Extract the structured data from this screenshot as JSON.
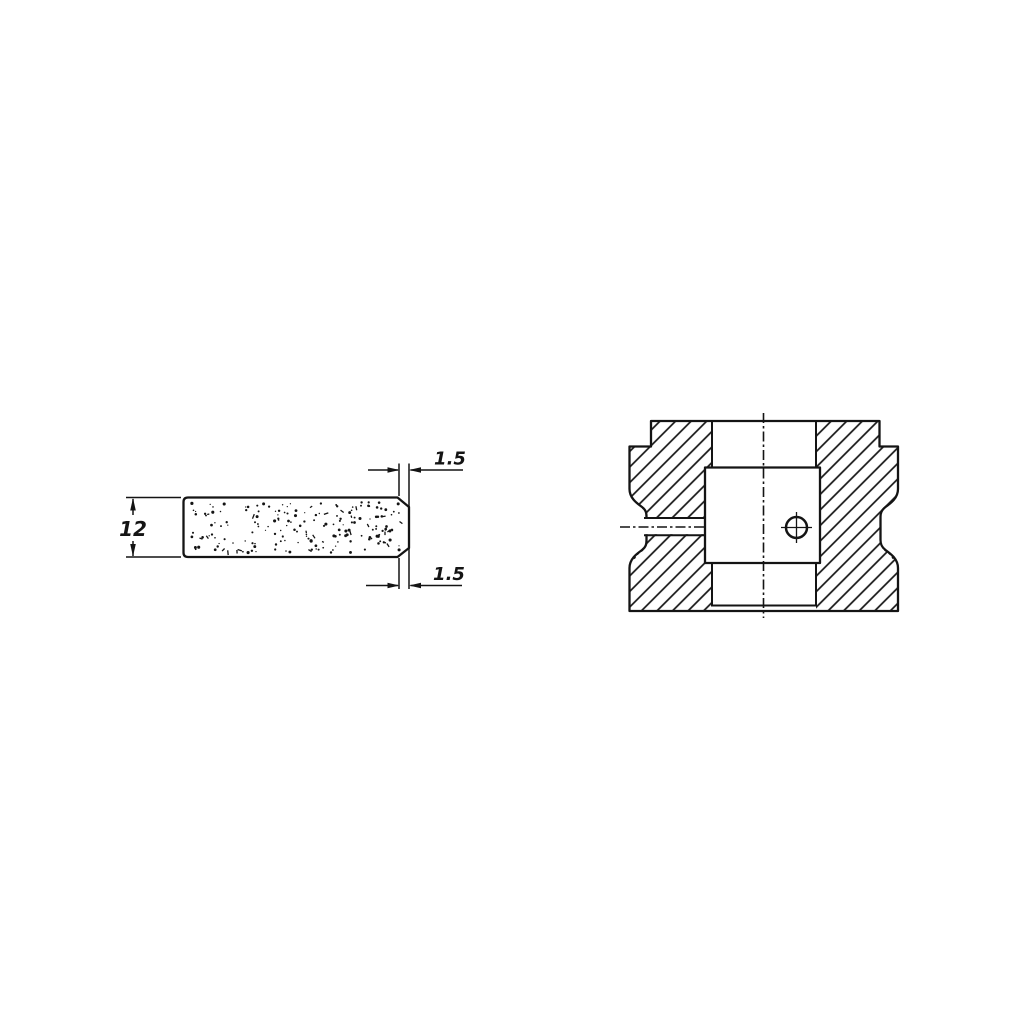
{
  "page": {
    "background": "#ffffff",
    "ink": "#141414"
  },
  "drawing": {
    "side_view": {
      "dimensions": {
        "height": {
          "label": "12"
        },
        "chamfer_top": {
          "label": "1.5"
        },
        "chamfer_bottom": {
          "label": "1.5"
        }
      }
    },
    "section_view": {
      "features": [
        "hatched-section-walls",
        "center-bore",
        "hub-boss",
        "cross-hole-marker",
        "radial-side-hole",
        "vertical-centerline",
        "horizontal-centerline"
      ]
    }
  }
}
